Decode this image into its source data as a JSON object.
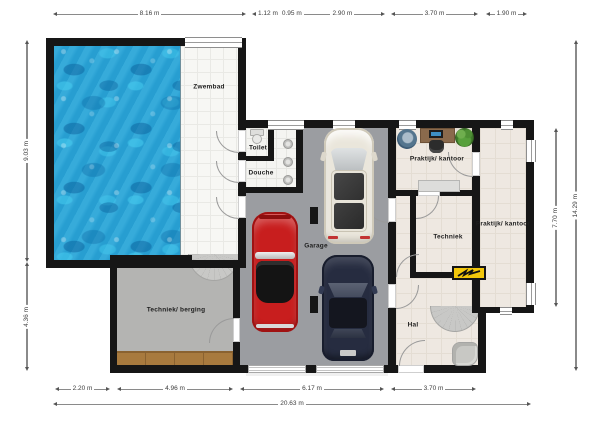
{
  "rooms": {
    "zwembad": "Zwembad",
    "toilet": "Toilet",
    "douche": "Douche",
    "garage": "Garage",
    "praktijk_top": "Praktijk/ kantoor",
    "techniek": "Techniek",
    "praktijk_right": "Praktijk/ kantoor",
    "hal": "Hal",
    "berging": "Techniek/ berging"
  },
  "dims": {
    "top": [
      "8.16 m",
      "1.12 m",
      "0.95 m",
      "2.90 m",
      "3.70 m",
      "1.90 m"
    ],
    "left": [
      "9.03 m",
      "4.36 m"
    ],
    "right": [
      "7.70 m",
      "14.29 m"
    ],
    "bottom": [
      "2.20 m",
      "4.96 m",
      "6.17 m",
      "3.70 m"
    ],
    "bottom_total": "20.63 m"
  },
  "objects": {
    "pool": "pool-water",
    "stairs_berging": "quarter-turn-stairs",
    "stairs_hal": "quarter-turn-stairs",
    "toilet_fixture": "toilet-fixture",
    "shower": "shower-heads",
    "car_red": "classic-sports-car",
    "car_white": "suv-panoramic-roof",
    "car_navy": "sedan",
    "chair_round": "round-lounge-chair",
    "desk": "desk-with-monitor",
    "plant": "potted-plant",
    "sideboard": "sideboard",
    "workbench": "workbench",
    "sign": "electrical-panel-sign",
    "armchair": "armchair"
  },
  "colors": {
    "wall": "#161616",
    "pool_water": "#2aa6d8",
    "pool_tile": "#f7f7f4",
    "garage_floor": "#9b9da1",
    "berging_floor": "#b4b4b2",
    "office_floor": "#eee8e1",
    "bench_wood": "#a87a3e",
    "sign_yellow": "#f3c70b",
    "car_red": "#c81e1e",
    "car_white": "#eae6db",
    "car_navy": "#262c40",
    "dim_text": "#3c3c3c"
  }
}
